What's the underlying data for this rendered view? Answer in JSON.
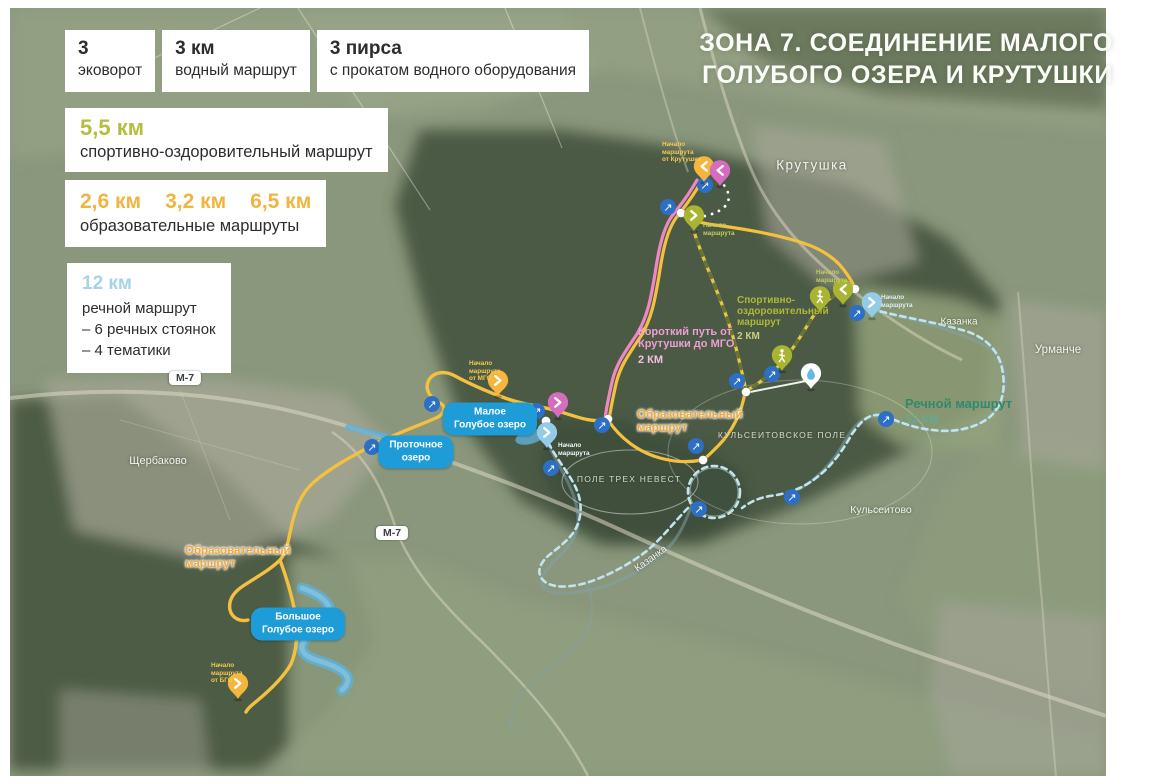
{
  "title": {
    "line1": "ЗОНА 7. СОЕДИНЕНИЕ МАЛОГО",
    "line2": "ГОЛУБОГО ОЗЕРА И КРУТУШКИ"
  },
  "legend": {
    "stats": [
      {
        "value": "3",
        "label": "эковорот"
      },
      {
        "value": "3 км",
        "label": "водный маршрут"
      },
      {
        "value": "3 пирса",
        "label": "с прокатом водного оборудования"
      }
    ],
    "sport": {
      "value": "5,5 км",
      "label": "спортивно-оздоровительный маршрут"
    },
    "edu": {
      "values": [
        "2,6 км",
        "3,2 км",
        "6,5 км"
      ],
      "label": "образовательные маршруты"
    },
    "river": {
      "value": "12 км",
      "line1": "речной маршрут",
      "line2": "– 6 речных стоянок",
      "line3": "– 4 тематики"
    }
  },
  "map": {
    "places": {
      "krutushka": "Крутушка",
      "shcherbakovo": "Щербаково",
      "urmanche": "Урманче",
      "kazanka_river_1": "Казанка",
      "kazanka_river_2": "Казанка",
      "kulseitovo": "Кульсеитово",
      "kulseitovskoe_pole": "КУЛЬСЕИТОВСКОЕ ПОЛЕ",
      "pole_treh_nevest": "ПОЛЕ ТРЕХ НЕВЕСТ"
    },
    "routes": {
      "edu_north": {
        "line1": "Образовательный",
        "line2": "маршрут"
      },
      "edu_south": {
        "line1": "Образовательный",
        "line2": "маршрут"
      },
      "sport": {
        "line1": "Спортивно-",
        "line2": "оздоровительный",
        "line3": "маршрут",
        "distance": "2 КМ"
      },
      "short_path": {
        "line1": "Короткий путь от",
        "line2": "Крутушки до МГО",
        "distance": "2 КМ"
      },
      "river": {
        "line1": "Речной маршрут",
        "distance": "12 КМ"
      }
    },
    "starts": {
      "krutushka": {
        "line1": "Начало",
        "line2": "маршрута",
        "line3": "от Крутушки"
      },
      "sport_west": {
        "line1": "Начало",
        "line2": "маршрута"
      },
      "sport_east": {
        "line1": "Начало",
        "line2": "маршрута"
      },
      "river": {
        "line1": "Начало",
        "line2": "маршрута"
      },
      "water": {
        "line1": "Начало",
        "line2": "маршрута"
      },
      "mgo": {
        "line1": "Начало",
        "line2": "маршрута",
        "line3": "от МГО"
      },
      "bgo": {
        "line1": "Начало",
        "line2": "маршрута",
        "line3": "от БГО"
      }
    },
    "lakes": {
      "maloe": {
        "line1": "Малое",
        "line2": "Голубое озеро"
      },
      "protochnoe": {
        "line1": "Проточное",
        "line2": "озеро"
      },
      "bolshoe": {
        "line1": "Большое",
        "line2": "Голубое озеро"
      }
    },
    "road_badges": {
      "m7_west": "М-7",
      "m7_south": "М-7"
    },
    "icons": {
      "direction_arrow": "↗"
    },
    "colors": {
      "sport_route": "#b4bc3e",
      "edu_route": "#f2bb42",
      "river_route": "#bfe3ef",
      "short_path_route": "#ef87c5",
      "direction_marker": "#2c6fc4",
      "lake_badge": "#1e9cd7",
      "legend_sport": "#b5bd3e",
      "legend_edu": "#f0b541",
      "legend_river": "#a5d3e8"
    }
  }
}
